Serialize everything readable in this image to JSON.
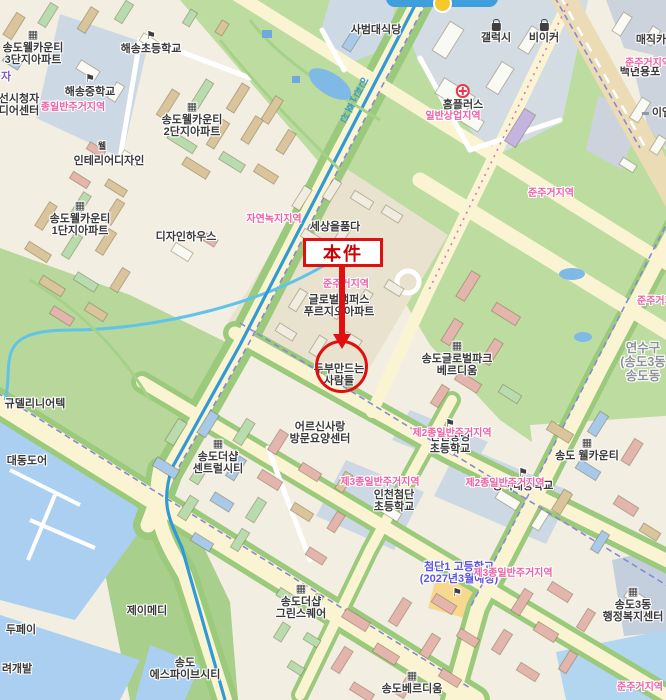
{
  "colors": {
    "annotation_red": "#e01010",
    "zone_pink": "#ee5fa7",
    "plan_blue": "#5b55e0",
    "subway_blue": "#3d9ad0",
    "district_gray": "#8e9498",
    "park_green": "#bddca0",
    "water_blue": "#aacff0",
    "road_yellow": "#fbf4d2"
  },
  "annotation": {
    "box_label": "本件"
  },
  "labels": [
    {
      "kind": "place",
      "icon": "building",
      "x": 33,
      "y": 30,
      "lines": [
        "송도웰카운티",
        "3단지아파트"
      ]
    },
    {
      "kind": "place",
      "icon": "school",
      "x": 151,
      "y": 31,
      "lines": [
        "해송초등학교"
      ]
    },
    {
      "kind": "place",
      "icon": "school",
      "x": 90,
      "y": 74,
      "lines": [
        "해송중학교"
      ]
    },
    {
      "kind": "place",
      "x": 376,
      "y": 24,
      "lines": [
        "사범대식당"
      ]
    },
    {
      "kind": "place",
      "icon": "bag",
      "x": 496,
      "y": 23,
      "lines": [
        "갤럭시"
      ]
    },
    {
      "kind": "place",
      "icon": "bag",
      "x": 544,
      "y": 23,
      "lines": [
        "비이커"
      ]
    },
    {
      "kind": "place",
      "icon": "homeplus",
      "x": 463,
      "y": 84,
      "lines": [
        "홈플러스"
      ]
    },
    {
      "kind": "place",
      "x": 651,
      "y": 34,
      "lines": [
        "매직카"
      ]
    },
    {
      "kind": "place",
      "x": 640,
      "y": 66,
      "lines": [
        "백년용포"
      ]
    },
    {
      "kind": "place",
      "icon": "dash",
      "x": 657,
      "y": 107,
      "lines": [
        "이엘"
      ]
    },
    {
      "kind": "place",
      "icon": "building",
      "x": 192,
      "y": 102,
      "lines": [
        "송도웰카운티",
        "2단지아파트"
      ]
    },
    {
      "kind": "place",
      "x": 102,
      "y": 141,
      "cls": " small",
      "lines": [
        "웰"
      ]
    },
    {
      "kind": "place",
      "x": 109,
      "y": 155,
      "lines": [
        "인테리어디자인"
      ]
    },
    {
      "kind": "place",
      "x": 19,
      "y": 93,
      "lines": [
        "선시청자",
        "디어센터"
      ]
    },
    {
      "kind": "fragment",
      "x": 6,
      "y": 71,
      "color": "#7d5fc0",
      "lines": [
        "자"
      ]
    },
    {
      "kind": "place",
      "icon": "building",
      "x": 80,
      "y": 201,
      "lines": [
        "송도웰카운티",
        "1단지아파트"
      ]
    },
    {
      "kind": "place",
      "x": 186,
      "y": 231,
      "lines": [
        "디자인하우스"
      ]
    },
    {
      "kind": "place",
      "x": 335,
      "y": 221,
      "lines": [
        "세상을품다"
      ]
    },
    {
      "kind": "place",
      "x": 339,
      "y": 294,
      "lines": [
        "글로벌캠퍼스",
        "푸르지오아파트"
      ]
    },
    {
      "kind": "place",
      "x": 339,
      "y": 363,
      "lines": [
        "두부만드는",
        "사람들"
      ]
    },
    {
      "kind": "place",
      "icon": "building",
      "x": 457,
      "y": 341,
      "lines": [
        "송도글로벌파크",
        "베르디움"
      ]
    },
    {
      "kind": "district",
      "x": 643,
      "y": 341,
      "lines": [
        "연수구",
        "(송도3동",
        "송도동"
      ]
    },
    {
      "kind": "place",
      "x": 35,
      "y": 398,
      "lines": [
        "규델리니어텍"
      ]
    },
    {
      "kind": "place",
      "x": 27,
      "y": 455,
      "lines": [
        "대동도어"
      ]
    },
    {
      "kind": "place",
      "icon": "building",
      "x": 218,
      "y": 439,
      "lines": [
        "송도더샵",
        "센트럴시티"
      ]
    },
    {
      "kind": "place",
      "x": 320,
      "y": 421,
      "lines": [
        "어르신사랑",
        "방문요양센터"
      ]
    },
    {
      "kind": "place",
      "icon": "school",
      "x": 450,
      "y": 419,
      "lines": [
        "인천송명",
        "초등학교"
      ]
    },
    {
      "kind": "place",
      "x": 394,
      "y": 489,
      "lines": [
        "인천첨단",
        "초등학교"
      ]
    },
    {
      "kind": "place",
      "icon": "school",
      "x": 523,
      "y": 468,
      "lines": [
        "능허대중학교"
      ]
    },
    {
      "kind": "place",
      "icon": "building",
      "x": 587,
      "y": 438,
      "lines": [
        "송도 웰카운티"
      ]
    },
    {
      "kind": "place",
      "x": 147,
      "y": 605,
      "lines": [
        "제이메디"
      ]
    },
    {
      "kind": "place",
      "x": 21,
      "y": 624,
      "lines": [
        "두페이"
      ]
    },
    {
      "kind": "place",
      "x": 17,
      "y": 663,
      "lines": [
        "려개발"
      ]
    },
    {
      "kind": "place",
      "x": 185,
      "y": 657,
      "lines": [
        "송도",
        "에스파이브시티"
      ]
    },
    {
      "kind": "place",
      "icon": "building",
      "x": 301,
      "y": 584,
      "lines": [
        "송도더샵",
        "그린스퀘어"
      ]
    },
    {
      "kind": "place",
      "icon": "building",
      "x": 633,
      "y": 587,
      "lines": [
        "송도3동",
        "행정복지센터"
      ]
    },
    {
      "kind": "place",
      "icon": "building",
      "x": 412,
      "y": 671,
      "lines": [
        "송도베르디움"
      ]
    },
    {
      "kind": "plan",
      "x": 459,
      "y": 561,
      "lines": [
        "첨단1 고등학교",
        "(2027년3월예정)"
      ]
    },
    {
      "kind": "place",
      "icon": "school",
      "x": 457,
      "y": 588,
      "cls": " iconly",
      "lines": []
    },
    {
      "kind": "zone",
      "x": 73,
      "y": 102,
      "lines": [
        "종일반주거지역"
      ]
    },
    {
      "kind": "zone",
      "x": 453,
      "y": 111,
      "lines": [
        "일반상업지역"
      ]
    },
    {
      "kind": "zone",
      "x": 648,
      "y": 58,
      "lines": [
        "준주거지역"
      ]
    },
    {
      "kind": "zone",
      "x": 551,
      "y": 188,
      "lines": [
        "준주거지역"
      ]
    },
    {
      "kind": "zone",
      "x": 274,
      "y": 214,
      "lines": [
        "자연녹지지역"
      ]
    },
    {
      "kind": "zone",
      "x": 346,
      "y": 279,
      "lines": [
        "준주거지역"
      ]
    },
    {
      "kind": "zone",
      "x": 660,
      "y": 296,
      "lines": [
        "준주거지역"
      ]
    },
    {
      "kind": "zone",
      "x": 452,
      "y": 428,
      "lines": [
        "제2종일반주거지역"
      ]
    },
    {
      "kind": "zone",
      "x": 380,
      "y": 477,
      "lines": [
        "제3종일반주거지역"
      ]
    },
    {
      "kind": "zone",
      "x": 505,
      "y": 478,
      "lines": [
        "제2종일반주거지역"
      ]
    },
    {
      "kind": "zone",
      "x": 513,
      "y": 568,
      "lines": [
        "제3종일반주거지역"
      ]
    },
    {
      "kind": "zone",
      "x": 640,
      "y": 682,
      "lines": [
        "준주거지역"
      ]
    },
    {
      "kind": "transit",
      "x": 352,
      "y": 74,
      "lines": [
        "인천1호선"
      ]
    }
  ]
}
